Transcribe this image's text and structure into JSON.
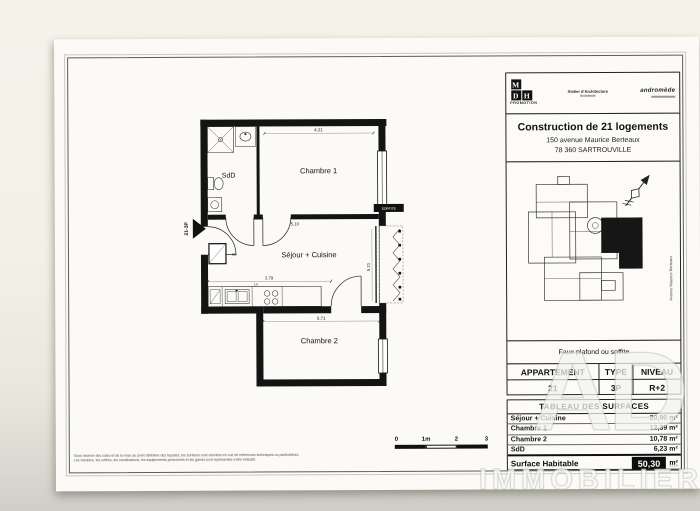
{
  "document": {
    "header": {
      "logo_letters": [
        "M",
        "D",
        "H"
      ],
      "logo_caption": "PROMOTION",
      "architect_line1": "Atelier d'Architecture",
      "architect_line2": "Architecte",
      "partner_logo": "andromède"
    },
    "project": {
      "title": "Construction de 21 logements",
      "address_line1": "150 avenue Maurice Berteaux",
      "address_line2": "78 360 SARTROUVILLE"
    },
    "site_plan": {
      "street_label": "Avenue Maurice Berteaux"
    },
    "note": "Faux plafond ou soffite",
    "apartment_table": {
      "headers": [
        "APPARTEMENT",
        "TYPE",
        "NIVEAU"
      ],
      "values": [
        "21",
        "3P",
        "R+2"
      ]
    },
    "surfaces_table": {
      "title": "TABLEAU DES SURFACES",
      "rows": [
        {
          "label": "Séjour + Cuisine",
          "value": "20,90 m²"
        },
        {
          "label": "Chambre 1",
          "value": "12,39 m²"
        },
        {
          "label": "Chambre 2",
          "value": "10,78 m²"
        },
        {
          "label": "SdD",
          "value": "6,23 m²"
        }
      ],
      "total_label": "Surface Habitable",
      "total_value": "50,30",
      "total_unit": "m²"
    },
    "fine_print": "2019",
    "disclaimer_line1": "Sous réserve des cotes et de la mise au point définitive des façades, les surfaces sont données en vue de références techniques ou particulières.",
    "disclaimer_line2": "Les meubles, les coffres, les canalisations, les équipements personnels et les gaines sont représentés à titre indicatif."
  },
  "floor_plan": {
    "rooms": {
      "sdd": "SdD",
      "chambre1": "Chambre 1",
      "sejour": "Séjour + Cuisine",
      "chambre2": "Chambre 2"
    },
    "entrance_label": "21-3P",
    "soffite_label": "SOFFITE",
    "kitchen_label": "LV",
    "closet_label": "EB",
    "dimensions": {
      "d1": "4.21",
      "d2": "5.10",
      "d3": "5.21",
      "d4": "3.79",
      "d5": "5.71"
    }
  },
  "scale_bar": {
    "labels": [
      "0",
      "1m",
      "2",
      "3"
    ]
  },
  "watermark": {
    "top": "AD",
    "bottom": "IMMOBILIER"
  }
}
